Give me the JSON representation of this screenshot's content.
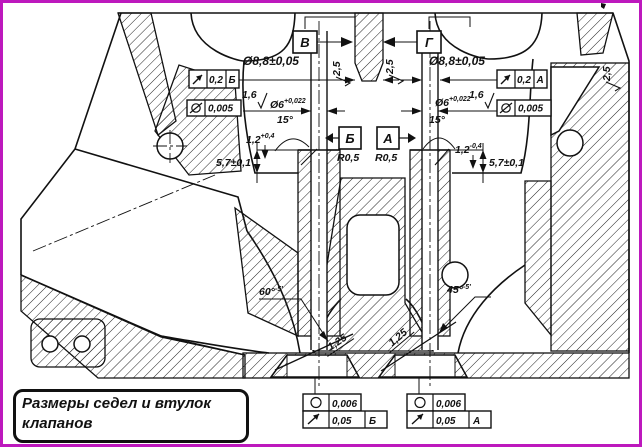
{
  "title": {
    "line1": "Размеры седел и втулок",
    "line2": "клапанов"
  },
  "colors": {
    "border": "#bd18bd",
    "line": "#111111",
    "background": "#ffffff"
  },
  "view_labels": {
    "left": "В",
    "right": "Г"
  },
  "datums": {
    "left": "Б",
    "right": "А"
  },
  "frames": {
    "top_left_runout": {
      "symbol": "circular-runout",
      "value": "0,2",
      "datum": "Б"
    },
    "top_left_form": {
      "symbol": "cylindricity",
      "value": "0,005"
    },
    "top_right_runout": {
      "symbol": "circular-runout",
      "value": "0,2",
      "datum": "А"
    },
    "top_right_form": {
      "symbol": "cylindricity",
      "value": "0,005"
    },
    "bottom_left_roundness": {
      "symbol": "roundness",
      "value": "0,006"
    },
    "bottom_left_runout": {
      "symbol": "circular-runout",
      "value": "0,05",
      "datum": "Б"
    },
    "bottom_right_roundness": {
      "symbol": "roundness",
      "value": "0,006"
    },
    "bottom_right_runout": {
      "symbol": "circular-runout",
      "value": "0,05",
      "datum": "А"
    }
  },
  "dims": {
    "left": {
      "guide_bore": "Ø8,8±0,05",
      "stem_bore_base": "Ø6",
      "stem_bore_tol": "+0,022",
      "bore_roughness": "1,6",
      "chamfer_angle": "15°",
      "chamfer_depth_base": "1,2",
      "chamfer_depth_tol": "+0,4",
      "guide_height": "5,7±0,1",
      "seat_fillet": "R0,5",
      "seat_angle_base": "60°",
      "seat_angle_tol": "-5'",
      "seat_roughness": "1,25",
      "top_roughness": "2,5"
    },
    "right": {
      "guide_bore": "Ø8,8±0,05",
      "stem_bore_base": "Ø6",
      "stem_bore_tol": "+0,022",
      "bore_roughness": "1,6",
      "chamfer_angle": "15°",
      "chamfer_depth_base": "1,2",
      "chamfer_depth_tol": "-0,4",
      "guide_height": "5,7±0,1",
      "seat_fillet": "R0,5",
      "seat_angle_base": "45°",
      "seat_angle_tol": "-5'",
      "seat_roughness": "1,25",
      "top_roughness": "2,5"
    },
    "far_right_roughness": "2,5"
  }
}
